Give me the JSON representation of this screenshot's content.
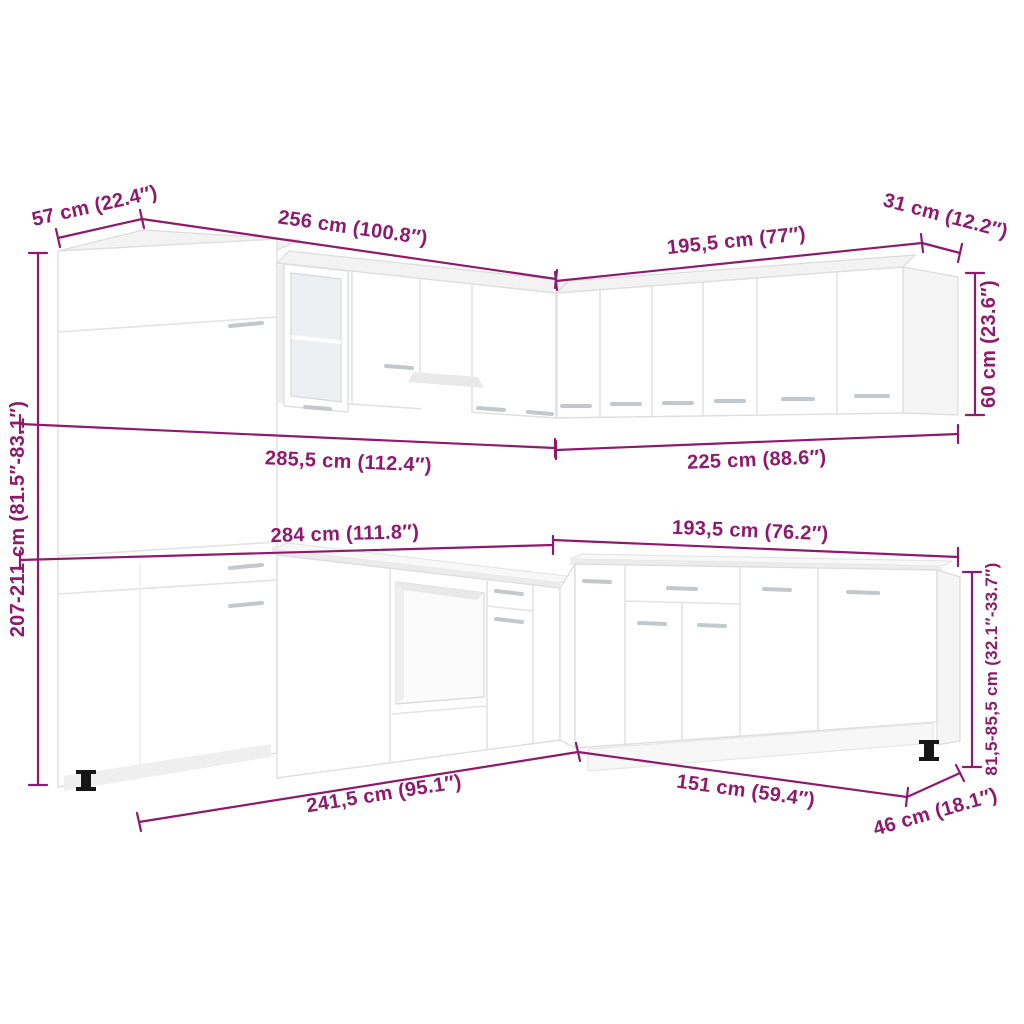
{
  "diagram": {
    "accent_color": "#8E1A6E",
    "cabinet_color": "#FFFFFF",
    "subject": "L-shaped kitchen cabinet set dimension diagram",
    "labels": {
      "tall_cabinet_depth": "57 cm (22.4″)",
      "upper_left_run": "256 cm (100.8″)",
      "upper_right_run": "195,5 cm (77″)",
      "wall_cabinet_depth": "31 cm (12.2″)",
      "wall_cabinet_height": "60 cm (23.6″)",
      "total_height": "207-211 cm (81.5″-83.1″)",
      "upper_left_total_width": "285,5 cm (112.4″)",
      "upper_right_total_width": "225 cm (88.6″)",
      "base_left_total_width": "284 cm (111.8″)",
      "base_right_total_width": "193,5 cm (76.2″)",
      "base_cabinet_height": "81,5-85,5 cm (32.1″-33.7″)",
      "base_left_run": "241,5 cm (95.1″)",
      "base_right_run": "151 cm (59.4″)",
      "base_cabinet_depth": "46 cm (18.1″)"
    }
  }
}
